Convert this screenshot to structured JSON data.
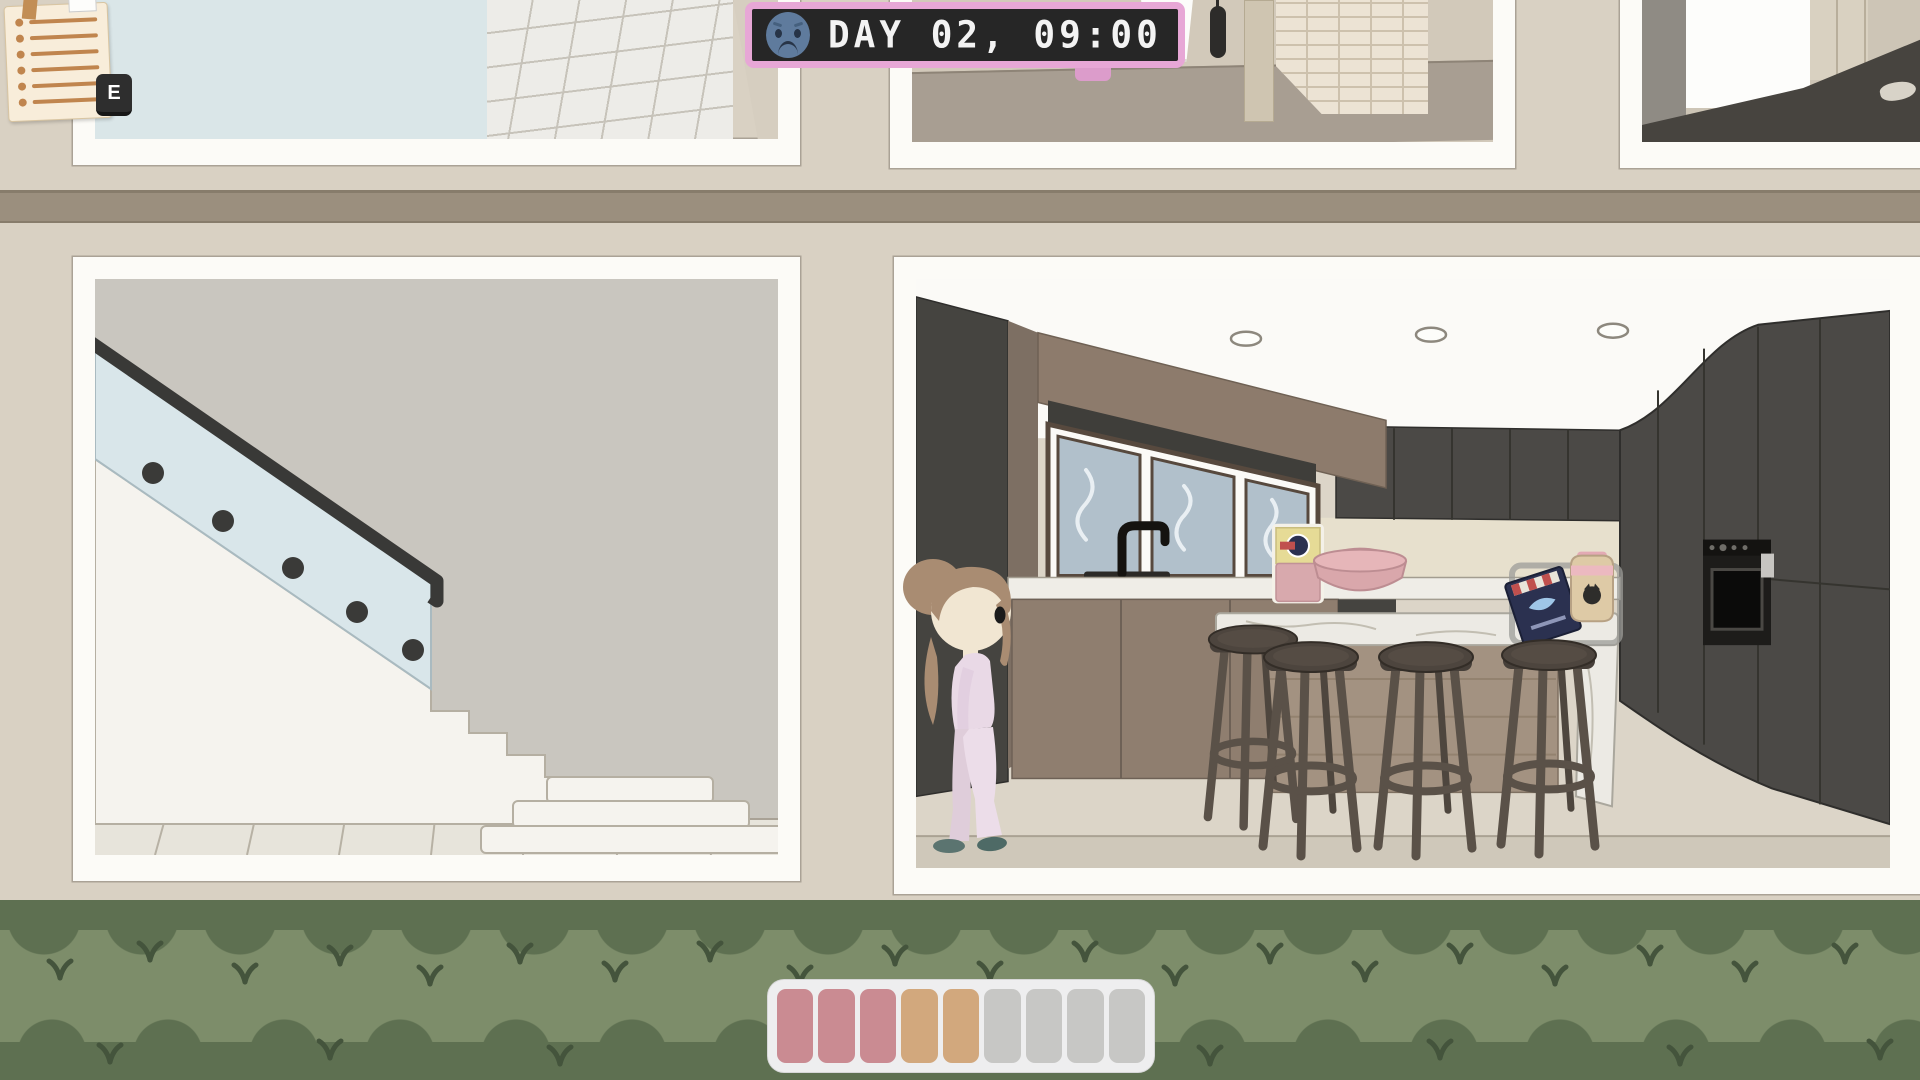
{
  "hud": {
    "clock": {
      "display": "DAY 02, 09:00",
      "day": "02",
      "time": "09:00",
      "mood": "sad",
      "colors": {
        "border": "#e7a7d6",
        "face": "#262626",
        "digits": "#f3f3f3",
        "emoji": "#5f7b9d"
      }
    },
    "todo_note": {
      "key_hint": "E",
      "line_count": 6
    },
    "status_bar": {
      "container_color": "#eeeeef",
      "segment_colors": [
        "#ca8b92",
        "#ca8b92",
        "#ca8b92",
        "#d2a87d",
        "#d2a87d",
        "#c7c7c5",
        "#c7c7c5",
        "#c7c7c5",
        "#c7c7c5"
      ]
    }
  },
  "scene": {
    "rooms": [
      "upper-bathroom",
      "upper-hallway",
      "upper-bedroom",
      "staircase",
      "kitchen"
    ],
    "character": {
      "name": "player-girl",
      "outfit_color": "#e9d9e6",
      "hair_color": "#a98c72"
    },
    "kitchen_items": [
      "flour-bag",
      "pink-bowl",
      "cereal-box",
      "milk-jar"
    ],
    "palette": {
      "wall": "#d9d1c3",
      "slab": "#9b8f7e",
      "hedge_light": "#7d8d6a",
      "hedge_dark": "#5e7051",
      "cabinet_charcoal": "#4b4946",
      "marble": "#eceae4",
      "wood": "#8f7e6f",
      "glass_rail": "#d9e6ea"
    }
  }
}
